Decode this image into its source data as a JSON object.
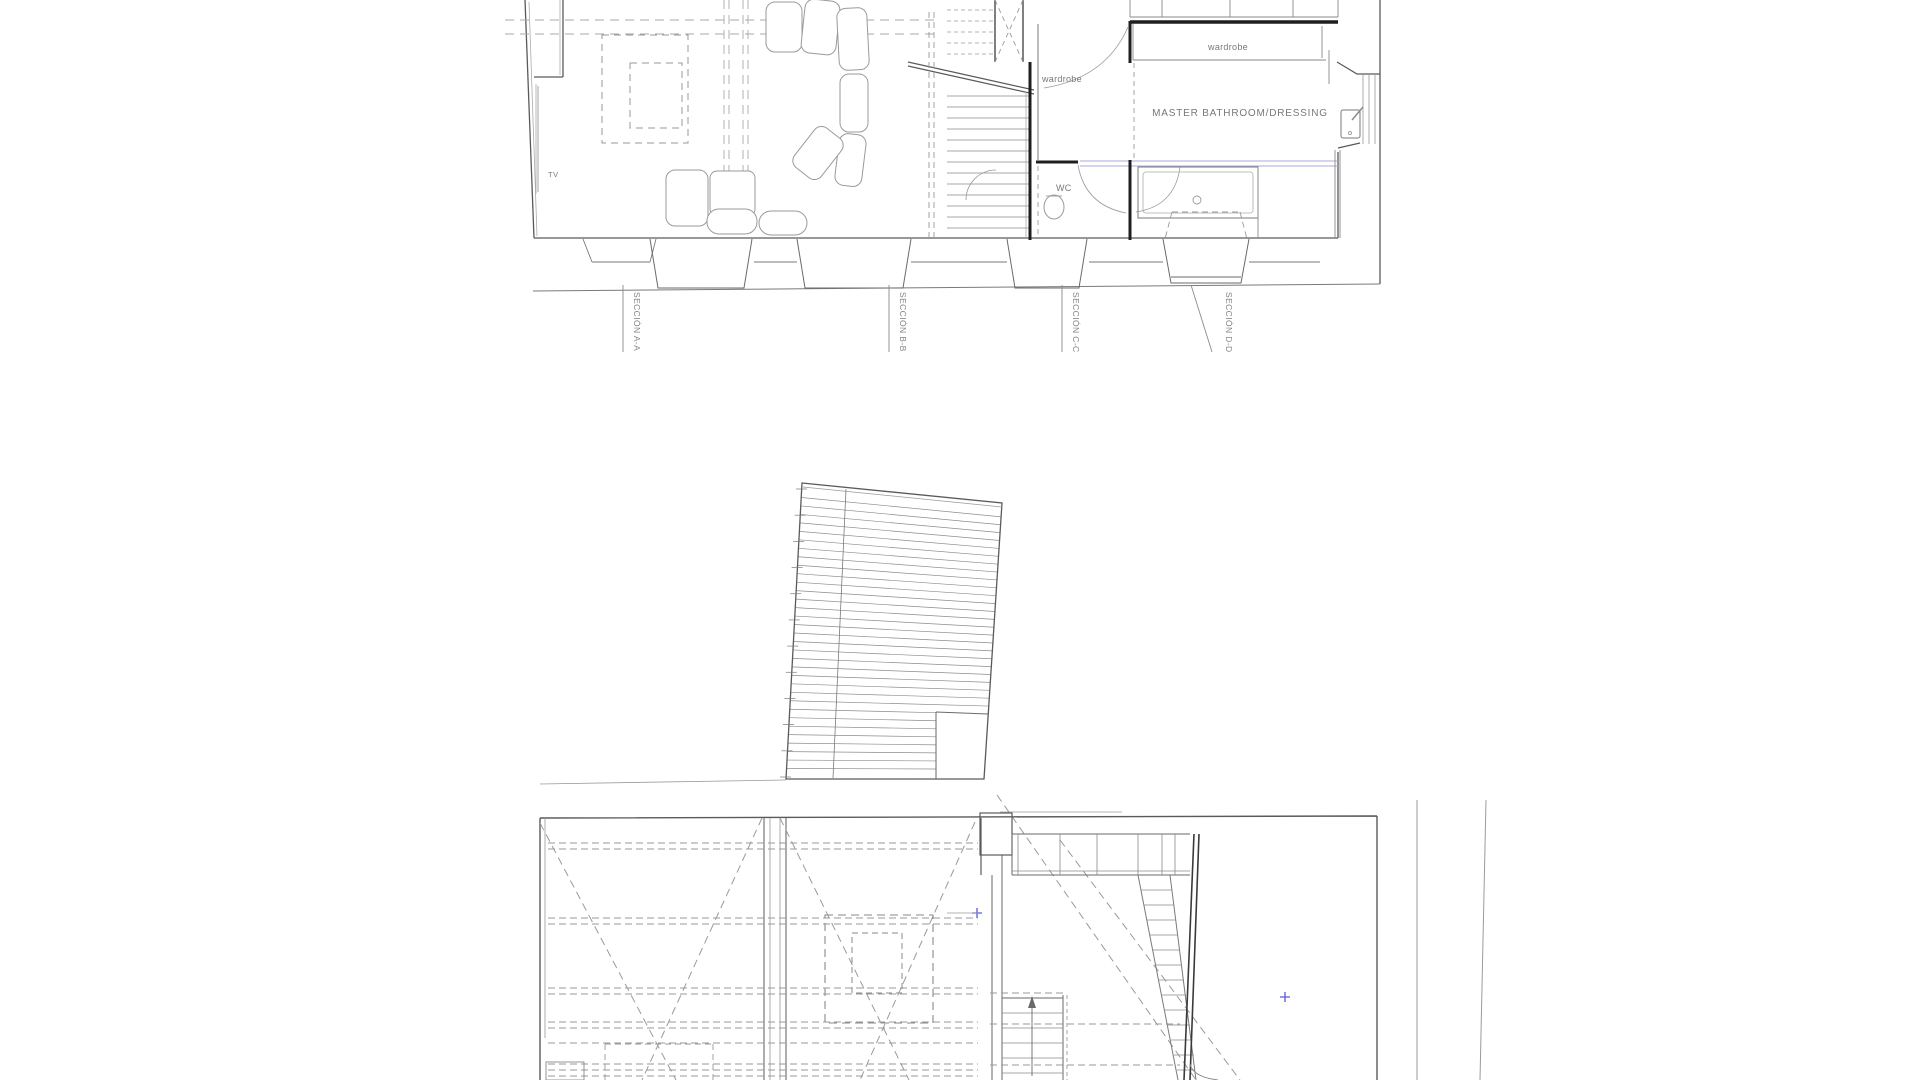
{
  "page": {
    "background": "#ffffff",
    "description": "architectural plan sheet"
  },
  "colors": {
    "wall": "#5a5a5a",
    "wall_dark": "#1f1f1f",
    "line_mid": "#8a8a8a",
    "line_light": "#aaaaaa",
    "dash": "#9a9a9a",
    "text": "#787878",
    "blue_accent": "#5b5bd6",
    "blue_line": "#a9a9d9"
  },
  "upper_plan": {
    "name": "upper floor plan",
    "labels": {
      "tv": "TV",
      "corridor_wardrobe": "wardrobe",
      "closet_wardrobe": "wardrobe",
      "master_bathroom": "MASTER BATHROOM/DRESSING",
      "wc": "WC"
    },
    "section_markers": [
      "SECCIÓN A-A",
      "SECCIÓN B-B",
      "SECCIÓN C-C",
      "SECCIÓN D-D"
    ]
  },
  "roof_plan": {
    "name": "roof plan",
    "slat_count": 33,
    "tick_count": 11
  },
  "lower_plan": {
    "name": "lower floor plan"
  }
}
